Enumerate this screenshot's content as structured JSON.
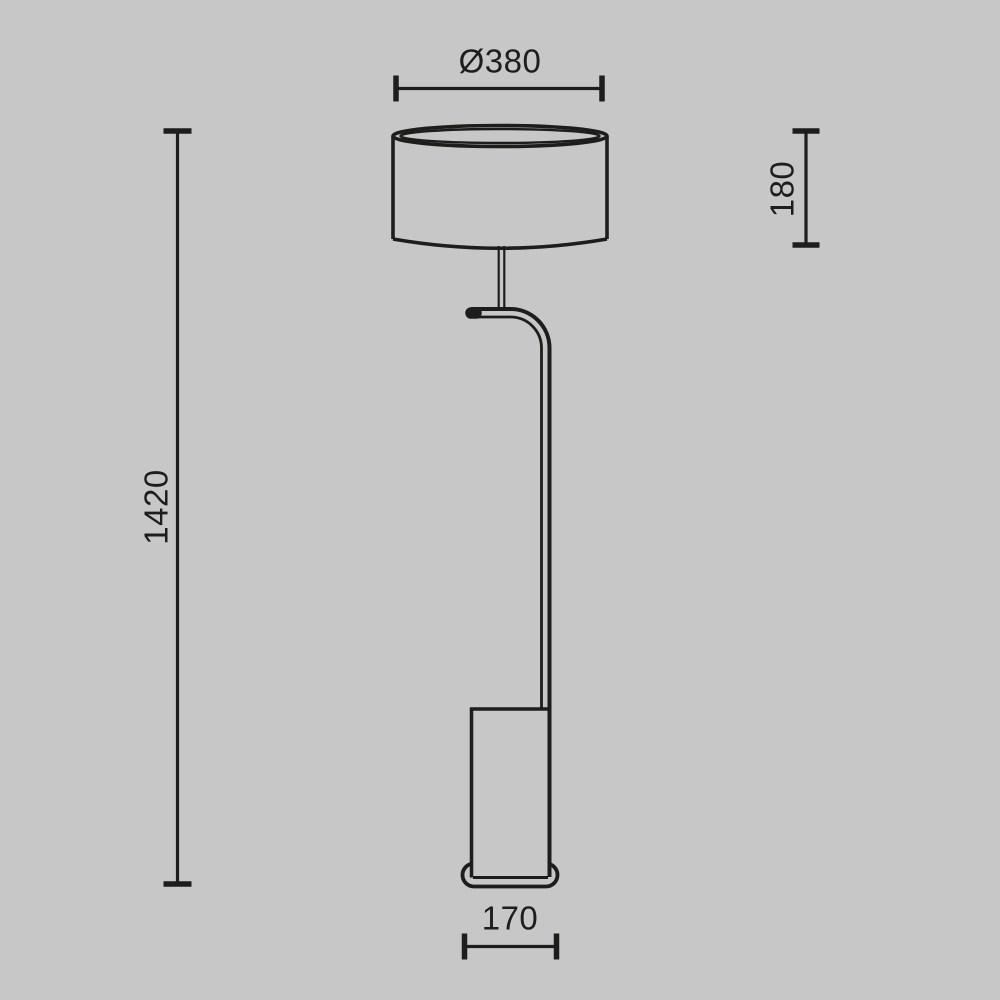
{
  "colors": {
    "background": "#c7c7c7",
    "line": "#1d1d1b"
  },
  "drawing": {
    "subject": "floor-lamp-technical-drawing",
    "dimensions": {
      "shade_diameter": {
        "label": "Ø380"
      },
      "shade_height": {
        "label": "180"
      },
      "total_height": {
        "label": "1420"
      },
      "base_width": {
        "label": "170"
      }
    }
  }
}
